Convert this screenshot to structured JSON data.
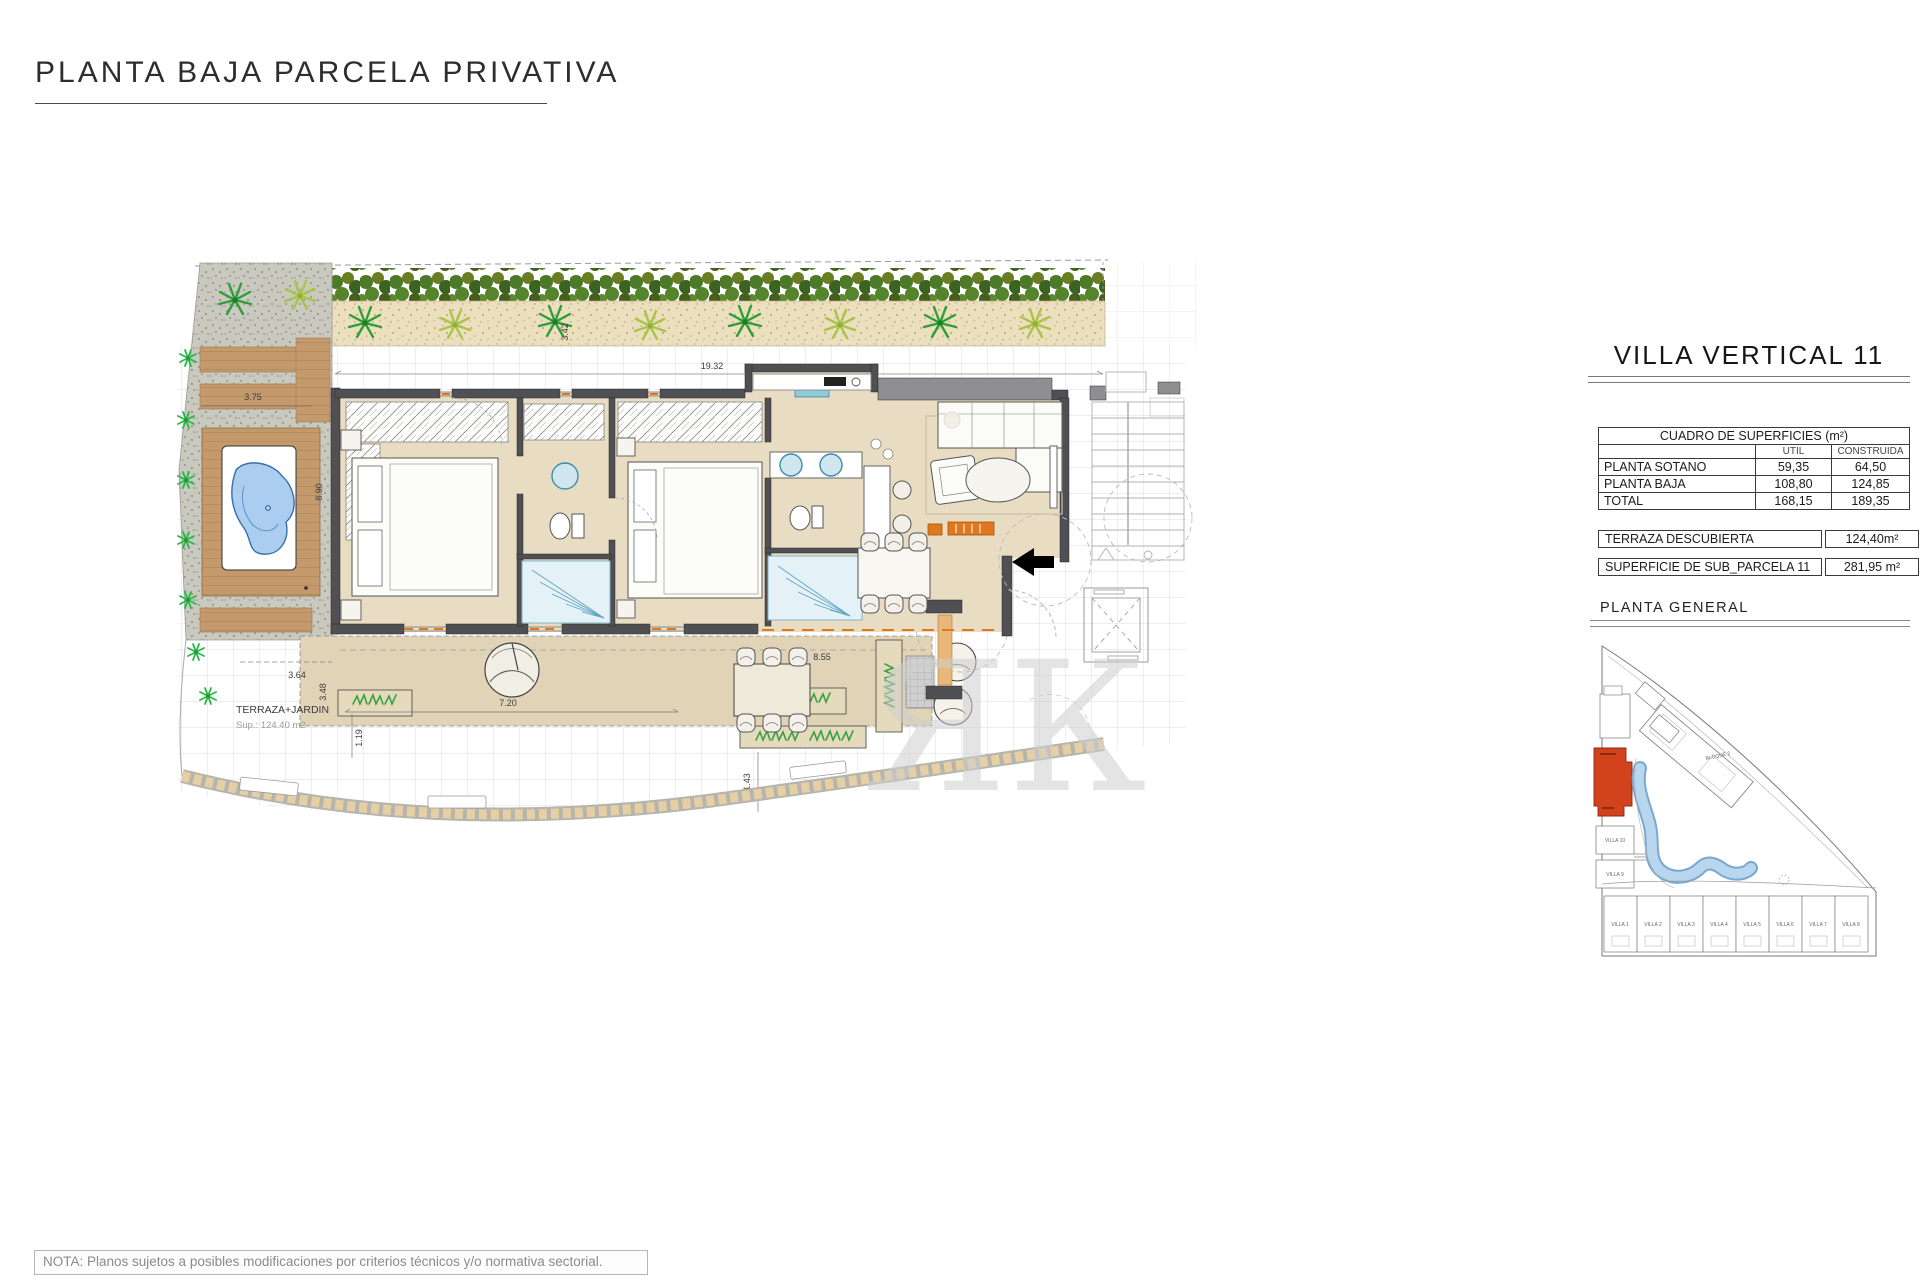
{
  "page": {
    "title": "PLANTA BAJA PARCELA PRIVATIVA",
    "note": "NOTA: Planos sujetos a posibles modificaciones por criterios técnicos y/o normativa sectorial."
  },
  "plan": {
    "terrace_label": "TERRAZA+JARDIN",
    "terrace_sup": "Sup.: 124.40 m2",
    "watermark": "ЯК",
    "dims": {
      "top": "19.32",
      "deck_w": "3.75",
      "deck_h": "8.90",
      "sand_h": "3.42",
      "terr_364": "3.64",
      "terr_348": "3.48",
      "terr_119": "1.19",
      "terr_720": "7.20",
      "terr_855": "8.55",
      "terr_143": "1.43",
      "living_319": "3.19"
    }
  },
  "panel": {
    "title": "VILLA VERTICAL 11",
    "surfaces_table": {
      "header": "CUADRO DE SUPERFICIES (m²)",
      "col_util": "UTIL",
      "col_construida": "CONSTRUIDA",
      "rows": [
        {
          "label": "PLANTA SOTANO",
          "util": "59,35",
          "construida": "64,50"
        },
        {
          "label": "PLANTA BAJA",
          "util": "108,80",
          "construida": "124,85"
        },
        {
          "label": "TOTAL",
          "util": "168,15",
          "construida": "189,35"
        }
      ]
    },
    "terraza": {
      "label": "TERRAZA DESCUBIERTA",
      "value": "124,40m²"
    },
    "subparcela": {
      "label": "SUPERFICIE DE SUB_PARCELA  11",
      "value": "281,95 m²"
    },
    "siteplan": {
      "title": "PLANTA  GENERAL",
      "bloque2": "BLOQUE 2",
      "villa10": "VILLA 10",
      "villa9": "VILLA 9",
      "bottom": [
        "VILLA 1",
        "VILLA 2",
        "VILLA 3",
        "VILLA 4",
        "VILLA 5",
        "VILLA 6",
        "VILLA 7",
        "VILLA 8"
      ]
    }
  },
  "colors": {
    "highlight_red": "#d2421c",
    "pool_blue": "#aacdf0",
    "accent_orange": "#e07820",
    "wall_gray": "#4f4f54"
  }
}
